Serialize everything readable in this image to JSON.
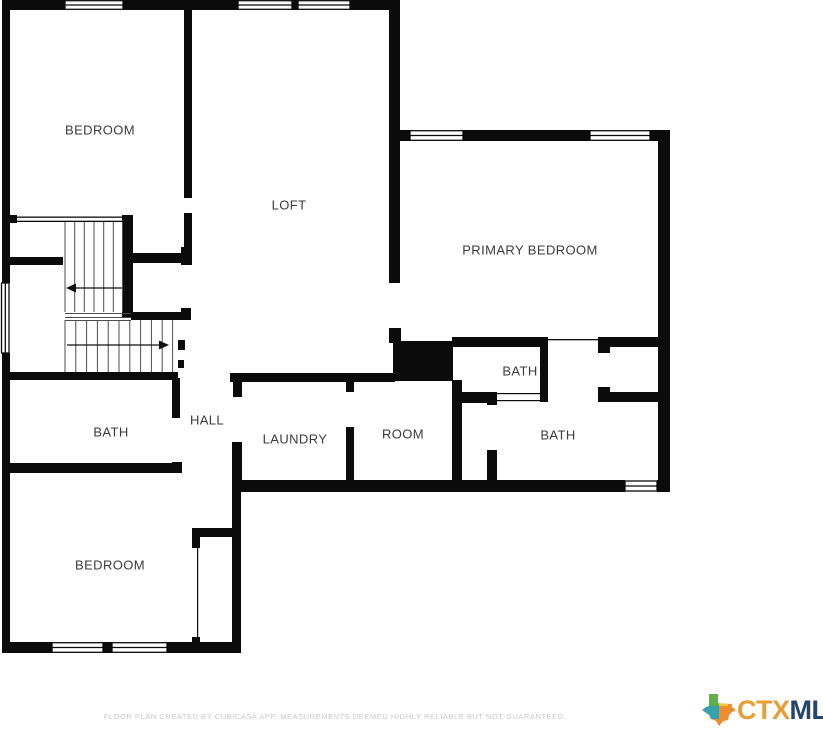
{
  "rooms": {
    "bedroom_top": {
      "label": "BEDROOM"
    },
    "loft": {
      "label": "LOFT"
    },
    "primary_bedroom": {
      "label": "PRIMARY BEDROOM"
    },
    "bath_upper": {
      "label": "BATH"
    },
    "bath_left": {
      "label": "BATH"
    },
    "hall": {
      "label": "HALL"
    },
    "laundry": {
      "label": "LAUNDRY"
    },
    "room": {
      "label": "ROOM"
    },
    "bath_right": {
      "label": "BATH"
    },
    "bedroom_bottom": {
      "label": "BEDROOM"
    }
  },
  "footer": {
    "disclaimer": "FLOOR PLAN CREATED BY CUBICASA APP. MEASUREMENTS DEEMED HIGHLY RELIABLE BUT NOT GUARANTEED."
  },
  "logo": {
    "ctx": "CTX",
    "mls": "MLS",
    "ctx_color": "#E89E35",
    "mls_color": "#25456A",
    "texas_colors": {
      "green": "#5CB247",
      "yellow": "#F4C53D",
      "orange": "#EF8D2E",
      "teal": "#3BA0AD"
    }
  },
  "colors": {
    "wall": "#0B0B0B",
    "label": "#3B3B3B",
    "stair_line": "#4D4D4D",
    "disclaimer": "#C9C9C9",
    "background": "#FFFFFF"
  }
}
